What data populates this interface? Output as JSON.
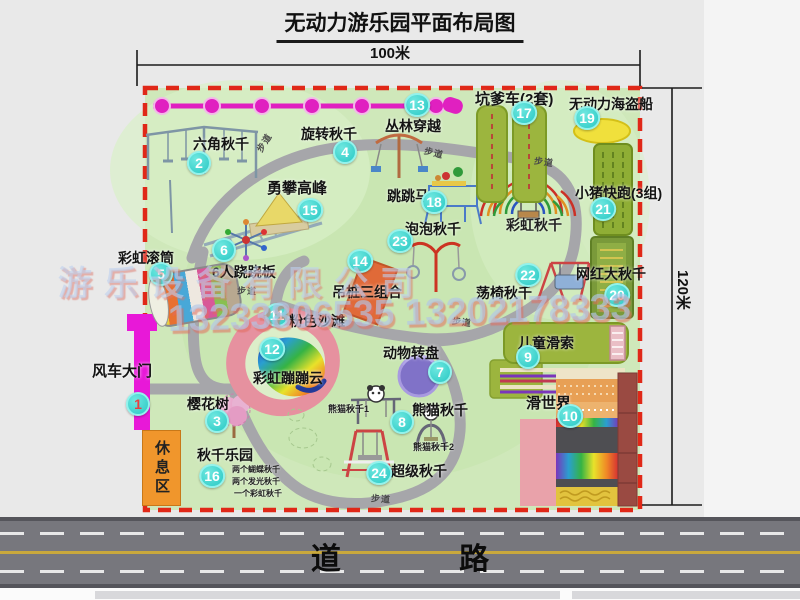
{
  "title": "无动力游乐园平面布局图",
  "dimensions": {
    "width_label": "100米",
    "height_label": "120米"
  },
  "road": {
    "label": "道 路"
  },
  "watermark": {
    "line1": "游乐设备有限公司",
    "line2": "13233806535 13202178333"
  },
  "rest_area": {
    "label": "休息区"
  },
  "walkway_label": "步道",
  "walkways": [
    {
      "x": 254,
      "y": 136,
      "r": -58
    },
    {
      "x": 424,
      "y": 146,
      "r": 14
    },
    {
      "x": 534,
      "y": 155,
      "r": 8
    },
    {
      "x": 237,
      "y": 284,
      "r": 3
    },
    {
      "x": 452,
      "y": 315,
      "r": 8
    },
    {
      "x": 371,
      "y": 492,
      "r": 4
    }
  ],
  "attractions": [
    {
      "num": "1",
      "name": "风车大门",
      "bx": 138,
      "by": 404,
      "lx": 92,
      "ly": 360,
      "fs": 15,
      "num_color": "#e84040"
    },
    {
      "num": "2",
      "name": "六角秋千",
      "bx": 199,
      "by": 163,
      "lx": 193,
      "ly": 134
    },
    {
      "num": "3",
      "name": "樱花树",
      "bx": 217,
      "by": 421,
      "lx": 187,
      "ly": 394
    },
    {
      "num": "4",
      "name": "旋转秋千",
      "bx": 345,
      "by": 152,
      "lx": 301,
      "ly": 124
    },
    {
      "num": "5",
      "name": "彩虹滚筒",
      "bx": 161,
      "by": 274,
      "lx": 118,
      "ly": 248
    },
    {
      "num": "6",
      "name": "6人跷跷板",
      "bx": 224,
      "by": 250,
      "lx": 212,
      "ly": 262
    },
    {
      "num": "7",
      "name": "动物转盘",
      "bx": 440,
      "by": 372,
      "lx": 383,
      "ly": 343
    },
    {
      "num": "8",
      "name": "熊猫秋千",
      "bx": 402,
      "by": 422,
      "lx": 412,
      "ly": 400
    },
    {
      "num": "9",
      "name": "儿童滑索",
      "bx": 528,
      "by": 357,
      "lx": 518,
      "ly": 333
    },
    {
      "num": "10",
      "name": "滑世界",
      "bx": 570,
      "by": 416,
      "lx": 526,
      "ly": 392,
      "fs": 15
    },
    {
      "num": "11",
      "name": "粉色沙滩",
      "bx": 277,
      "by": 315,
      "lx": 289,
      "ly": 311
    },
    {
      "num": "12",
      "name": "彩虹蹦蹦云",
      "bx": 272,
      "by": 349,
      "lx": 253,
      "ly": 368
    },
    {
      "num": "13",
      "name": "丛林穿越",
      "bx": 417,
      "by": 105,
      "lx": 385,
      "ly": 116
    },
    {
      "num": "14",
      "name": "吊桩三组合",
      "bx": 360,
      "by": 261,
      "lx": 332,
      "ly": 282
    },
    {
      "num": "15",
      "name": "勇攀高峰",
      "bx": 310,
      "by": 210,
      "lx": 267,
      "ly": 177,
      "fs": 15
    },
    {
      "num": "16",
      "name": "秋千乐园",
      "bx": 212,
      "by": 476,
      "lx": 197,
      "ly": 445
    },
    {
      "num": "17",
      "name": "坑爹车(2套)",
      "bx": 524,
      "by": 113,
      "lx": 475,
      "ly": 88,
      "fs": 15
    },
    {
      "num": "18",
      "name": "跳跳马",
      "bx": 434,
      "by": 202,
      "lx": 387,
      "ly": 186
    },
    {
      "num": "19",
      "name": "无动力海盗船",
      "bx": 587,
      "by": 118,
      "lx": 569,
      "ly": 94
    },
    {
      "num": "20",
      "name": "网红大秋千",
      "bx": 617,
      "by": 295,
      "lx": 576,
      "ly": 264
    },
    {
      "num": "21",
      "name": "小猪快跑(3组)",
      "bx": 603,
      "by": 209,
      "lx": 575,
      "ly": 183
    },
    {
      "num": "22",
      "name": "荡椅秋千",
      "bx": 528,
      "by": 275,
      "lx": 476,
      "ly": 283
    },
    {
      "num": "23",
      "name": "泡泡秋千",
      "bx": 400,
      "by": 241,
      "lx": 405,
      "ly": 219
    },
    {
      "num": "24",
      "name": "超级秋千",
      "bx": 379,
      "by": 473,
      "lx": 391,
      "ly": 461
    }
  ],
  "extra_labels": [
    {
      "text": "彩虹秋千",
      "x": 506,
      "y": 215,
      "fs": 14
    },
    {
      "text": "熊猫秋千1",
      "x": 328,
      "y": 402,
      "fs": 9
    },
    {
      "text": "熊猫秋千2",
      "x": 413,
      "y": 440,
      "fs": 9
    },
    {
      "text": "两个蝴蝶秋千",
      "x": 232,
      "y": 464,
      "fs": 8
    },
    {
      "text": "两个发光秋千",
      "x": 232,
      "y": 476,
      "fs": 8
    },
    {
      "text": "一个彩虹秋千",
      "x": 234,
      "y": 488,
      "fs": 8
    }
  ],
  "colors": {
    "park_green": "#cfe8ba",
    "border_red": "#e02818",
    "badge_cyan": "#29c8c4",
    "gate_magenta": "#e818d8",
    "zipline_pink": "#e020c0",
    "road_gray": "#77777d",
    "rest_orange": "#f0962c",
    "path_gray": "#a6a6aa"
  }
}
